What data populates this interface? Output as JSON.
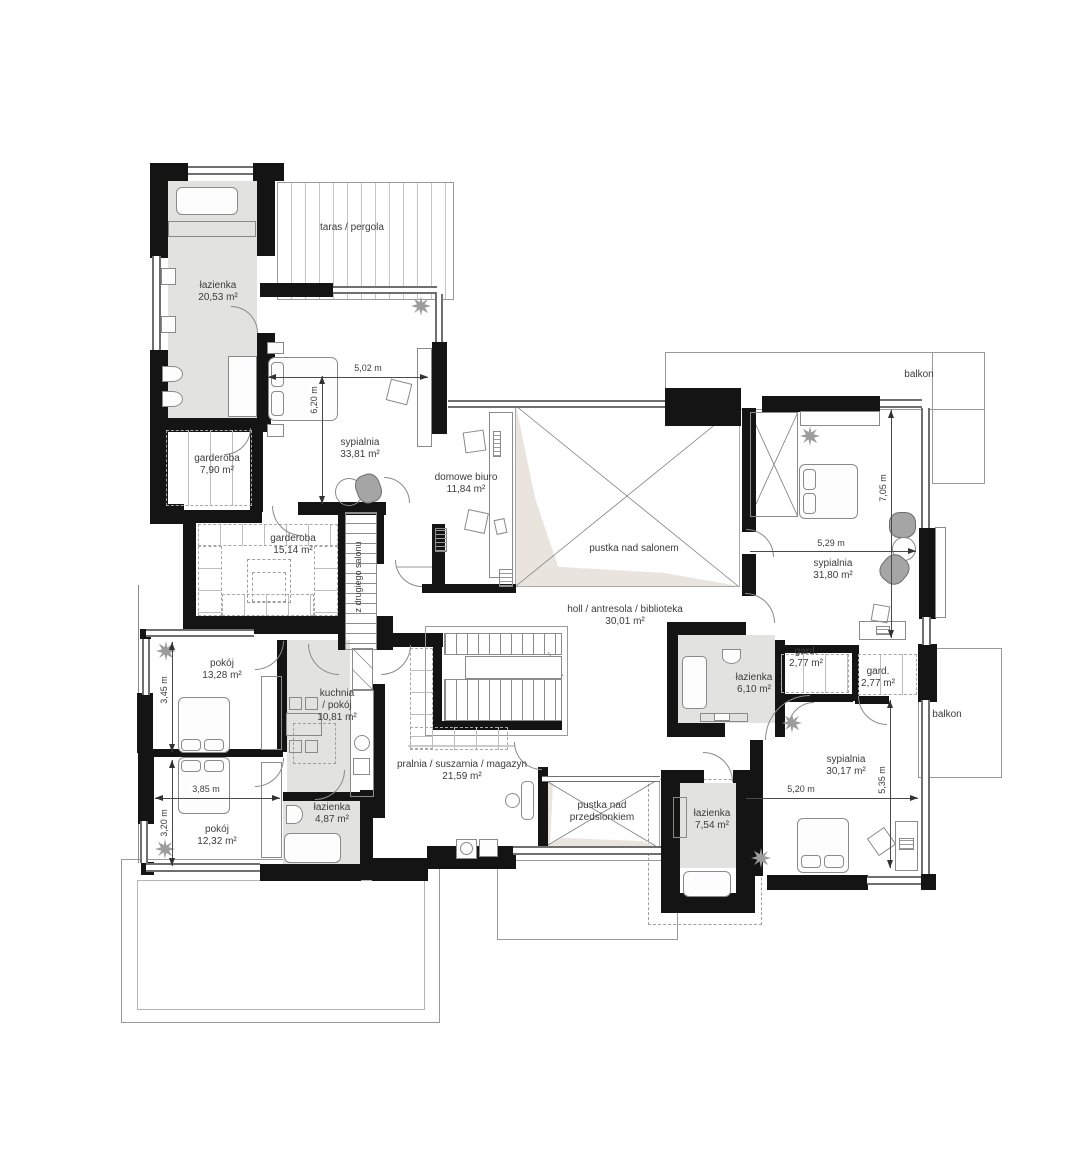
{
  "plan": {
    "rooms": {
      "lazienka1": {
        "label": "łazienka",
        "area": "20,53 m²"
      },
      "taras": {
        "label": "taras / pergola"
      },
      "sypialnia1": {
        "label": "sypialnia",
        "area": "33,81 m²"
      },
      "garderoba1": {
        "label": "garderoba",
        "area": "7,90 m²"
      },
      "garderoba2": {
        "label": "garderoba",
        "area": "15,14 m²"
      },
      "stairs_note": {
        "label": "z drugiego salonu"
      },
      "biuro": {
        "label": "domowe biuro",
        "area": "11,84 m²"
      },
      "pustka_salon": {
        "label": "pustka nad salonem"
      },
      "holl": {
        "label": "holl / antresola / biblioteka",
        "area": "30,01 m²"
      },
      "balkon_gorny": {
        "label": "balkon"
      },
      "sypialnia2": {
        "label": "sypialnia",
        "area": "31,80 m²"
      },
      "gard_a": {
        "label": "gard.",
        "area": "2,77 m²"
      },
      "gard_b": {
        "label": "gard.",
        "area": "2,77 m²"
      },
      "lazienka2": {
        "label": "łazienka",
        "area": "6,10 m²"
      },
      "balkon_boczny": {
        "label": "balkon"
      },
      "sypialnia3": {
        "label": "sypialnia",
        "area": "30,17 m²"
      },
      "pokoj1": {
        "label": "pokój",
        "area": "13,28 m²"
      },
      "kuchnia": {
        "line1": "kuchnia",
        "line2": "/ pokój",
        "area": "10,81 m²"
      },
      "pralnia": {
        "label": "pralnia / suszarnia / magazyn",
        "area": "21,59 m²"
      },
      "pustka_przedsionek": {
        "line1": "pustka nad",
        "line2": "przedsionkiem"
      },
      "lazienka3": {
        "label": "łazienka",
        "area": "7,54 m²"
      },
      "pokoj2": {
        "label": "pokój",
        "area": "12,32 m²"
      },
      "lazienka4": {
        "label": "łazienka",
        "area": "4,87 m²"
      }
    },
    "dimensions": {
      "d_5_02": "5,02 m",
      "d_6_20": "6,20 m",
      "d_7_05": "7,05 m",
      "d_5_29": "5,29 m",
      "d_3_45": "3,45 m",
      "d_3_85": "3,85 m",
      "d_3_20": "3,20 m",
      "d_5_20": "5,20 m",
      "d_5_35": "5,35 m"
    },
    "colors": {
      "wall": "#141414",
      "wet_room_fill": "#e2e2e0",
      "void_fill": "#e9e4de",
      "line": "#8a8a8a"
    }
  }
}
